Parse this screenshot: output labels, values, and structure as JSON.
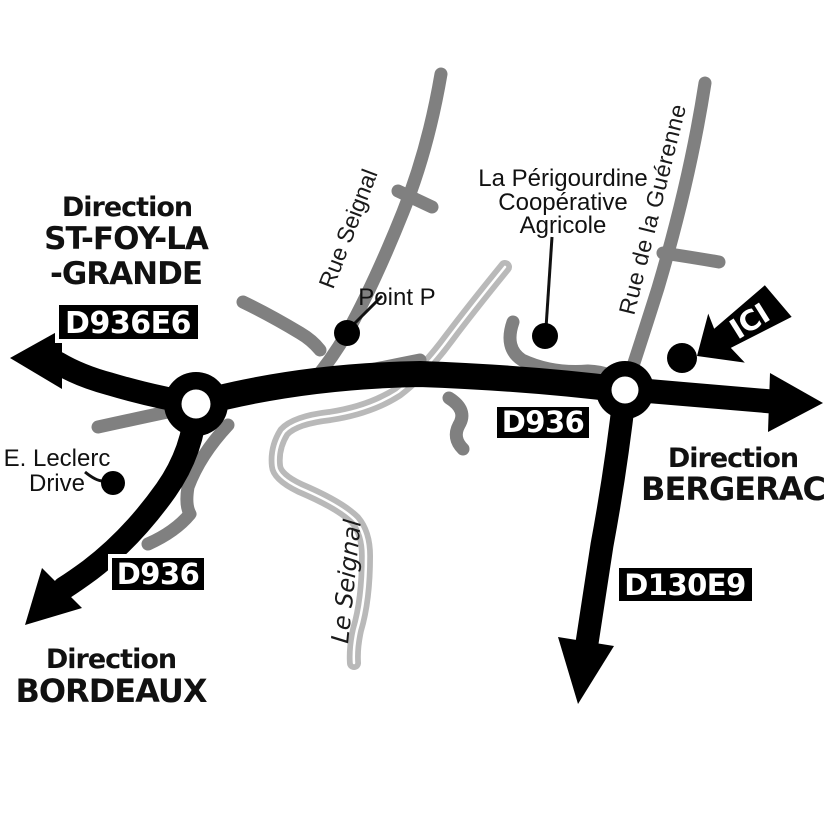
{
  "map": {
    "destinations": {
      "st_foy_la_grande": {
        "direction_label": "Direction",
        "name_line1": "ST-FOY-LA",
        "name_line2": "-GRANDE"
      },
      "bergerac": {
        "direction_label": "Direction",
        "name": "BERGERAC"
      },
      "bordeaux": {
        "direction_label": "Direction",
        "name": "BORDEAUX"
      }
    },
    "road_badges": {
      "d936e6": "D936E6",
      "d936_center": "D936",
      "d936_southwest": "D936",
      "d130e9": "D130E9"
    },
    "streets": {
      "rue_seignal": "Rue Seignal",
      "rue_de_la_guerenne": "Rue de la Guérenne"
    },
    "river_label": "Le Seignal",
    "pois": {
      "point_p": "Point P",
      "cooperative": {
        "line1": "La Périgourdine",
        "line2": "Coopérative",
        "line3": "Agricole"
      },
      "leclerc": {
        "line1": "E. Leclerc",
        "line2": "Drive"
      },
      "here_marker": "ICI"
    },
    "colors": {
      "road_primary": "#000000",
      "road_secondary": "#808080",
      "river": "#b9b9b9",
      "badge_background": "#000000",
      "badge_text": "#ffffff",
      "label_text": "#111111"
    }
  }
}
